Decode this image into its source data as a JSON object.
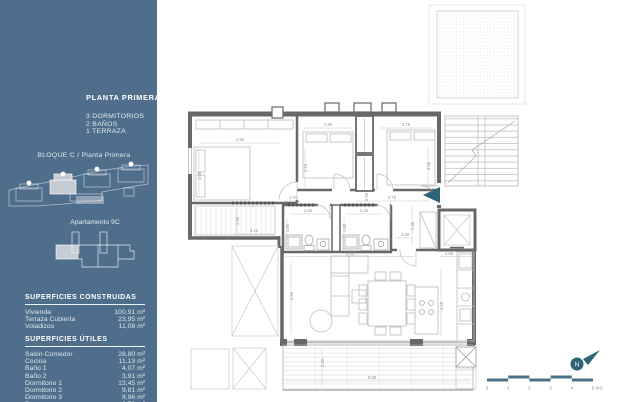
{
  "sidebar": {
    "title": "PLANTA PRIMERA",
    "features": [
      "3 DORMITORIOS",
      "2 BAÑOS",
      "1 TERRAZA"
    ],
    "block_label": "BLOQUE C / Planta Primera",
    "apartment_label": "Apartamento 9C",
    "tables": {
      "construidas": {
        "heading": "SUPERFICIES CONSTRUIDAS",
        "rows": [
          {
            "label": "Vivienda",
            "value": "100,91 m²"
          },
          {
            "label": "Terraza Cubierta",
            "value": "23,95 m²"
          },
          {
            "label": "Voladizos",
            "value": "11,08 m²"
          }
        ]
      },
      "utiles": {
        "heading": "SUPERFICIES ÚTILES",
        "rows": [
          {
            "label": "Salón-Comedor",
            "value": "28,80 m²"
          },
          {
            "label": "Cocina",
            "value": "11,13 m²"
          },
          {
            "label": "Baño 1",
            "value": "4,07 m²"
          },
          {
            "label": "Baño 2",
            "value": "3,91 m²"
          },
          {
            "label": "Dormitorio 1",
            "value": "13,45 m²"
          },
          {
            "label": "Dormitorio 2",
            "value": "9,81 m²"
          },
          {
            "label": "Dormitorio 3",
            "value": "8,96 m²"
          },
          {
            "label": "Paso",
            "value": "6,52 m²"
          }
        ]
      }
    },
    "colors": {
      "background": "#4f6e8b",
      "highlight": "#c5ccd3"
    }
  },
  "floor_plan": {
    "compass_letter": "N",
    "accent_color": "#2e6478",
    "scale_bar": {
      "color": "#4c7186",
      "labels": [
        "0",
        "1",
        "2",
        "3",
        "4",
        "5 (m)"
      ]
    },
    "dimensions": [
      {
        "t": "2.80",
        "x": 240,
        "y": 141,
        "r": 0
      },
      {
        "t": "3.68",
        "x": 201,
        "y": 176,
        "r": 1
      },
      {
        "t": "2.86",
        "x": 328,
        "y": 126,
        "r": 0
      },
      {
        "t": "3.23",
        "x": 307,
        "y": 168,
        "r": 1
      },
      {
        "t": "2.76",
        "x": 406,
        "y": 126,
        "r": 0
      },
      {
        "t": "3.08",
        "x": 430,
        "y": 166,
        "r": 1
      },
      {
        "t": "2.10",
        "x": 254,
        "y": 232,
        "r": 0
      },
      {
        "t": "1.50",
        "x": 239,
        "y": 221,
        "r": 1
      },
      {
        "t": "1.70",
        "x": 293,
        "y": 199,
        "r": 0
      },
      {
        "t": "0.98",
        "x": 368,
        "y": 197,
        "r": 1
      },
      {
        "t": "3.70",
        "x": 392,
        "y": 199,
        "r": 0
      },
      {
        "t": "2.55",
        "x": 308,
        "y": 212,
        "r": 0
      },
      {
        "t": "1.80",
        "x": 289,
        "y": 228,
        "r": 1
      },
      {
        "t": "2.40",
        "x": 364,
        "y": 212,
        "r": 0
      },
      {
        "t": "1.80",
        "x": 346,
        "y": 228,
        "r": 1
      },
      {
        "t": "1.28",
        "x": 405,
        "y": 236,
        "r": 0
      },
      {
        "t": "2.50",
        "x": 414,
        "y": 226,
        "r": 1
      },
      {
        "t": "2.68",
        "x": 449,
        "y": 255,
        "r": 0
      },
      {
        "t": "6.48",
        "x": 350,
        "y": 255,
        "r": 0
      },
      {
        "t": "4.56",
        "x": 293,
        "y": 296,
        "r": 1
      },
      {
        "t": "4.28",
        "x": 443,
        "y": 306,
        "r": 1
      },
      {
        "t": "2.20",
        "x": 324,
        "y": 363,
        "r": 1
      },
      {
        "t": "8.88",
        "x": 372,
        "y": 379,
        "r": 0
      }
    ]
  }
}
